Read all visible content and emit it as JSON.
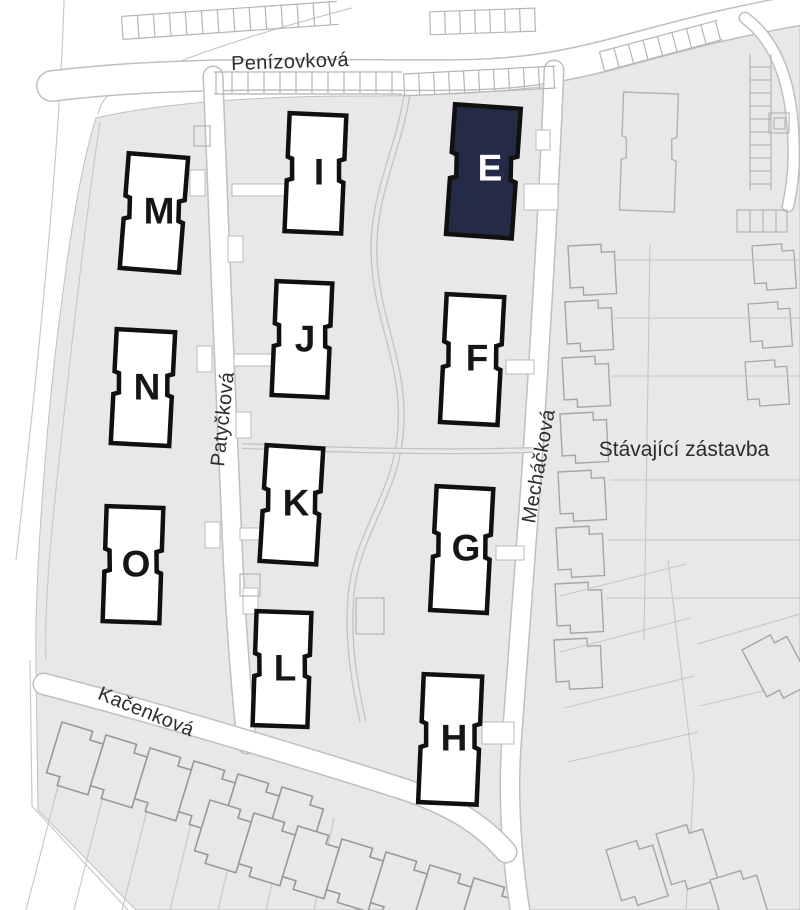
{
  "map": {
    "area_label": "Stávající zástavba",
    "streets": [
      {
        "name": "Penízovková"
      },
      {
        "name": "Patyčková"
      },
      {
        "name": "Mecháčková"
      },
      {
        "name": "Kačenková"
      }
    ],
    "buildings": [
      {
        "letter": "E",
        "highlighted": true
      },
      {
        "letter": "F",
        "highlighted": false
      },
      {
        "letter": "G",
        "highlighted": false
      },
      {
        "letter": "H",
        "highlighted": false
      },
      {
        "letter": "I",
        "highlighted": false
      },
      {
        "letter": "J",
        "highlighted": false
      },
      {
        "letter": "K",
        "highlighted": false
      },
      {
        "letter": "L",
        "highlighted": false
      },
      {
        "letter": "M",
        "highlighted": false
      },
      {
        "letter": "N",
        "highlighted": false
      },
      {
        "letter": "O",
        "highlighted": false
      }
    ],
    "colors": {
      "highlight": "#252a46",
      "land": "#e8e8ea",
      "building_fill": "#ffffff",
      "building_stroke": "#101010",
      "street": "#ffffff",
      "outline": "#bfbfc1"
    }
  }
}
